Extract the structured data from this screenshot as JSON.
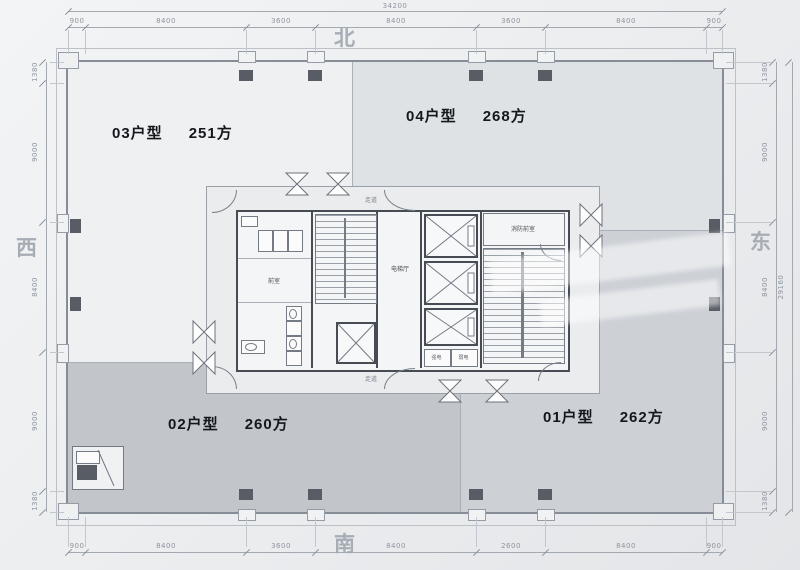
{
  "compass": {
    "north": "北",
    "south": "南",
    "west": "西",
    "east": "东"
  },
  "dims": {
    "total_top": "34200",
    "total_right": "29160",
    "top": [
      "900",
      "8400",
      "3600",
      "8400",
      "3600",
      "8400",
      "900"
    ],
    "bottom": [
      "900",
      "8400",
      "3600",
      "8400",
      "2600",
      "8400",
      "900"
    ],
    "left": [
      "1380",
      "9000",
      "8400",
      "9000",
      "1380"
    ],
    "right": [
      "1380",
      "9000",
      "8400",
      "9000",
      "1380"
    ]
  },
  "units": {
    "u03": {
      "name": "03户型",
      "area": "251方"
    },
    "u04": {
      "name": "04户型",
      "area": "268方"
    },
    "u02": {
      "name": "02户型",
      "area": "260方"
    },
    "u01": {
      "name": "01户型",
      "area": "262方"
    }
  },
  "core": {
    "elevator_hall": "电梯厅",
    "fire_lobby": "消防前室",
    "vestibule": "前室",
    "corridor_top": "走道",
    "corridor_bottom": "走道",
    "strong_power": "强电",
    "weak_power": "弱电"
  },
  "colors": {
    "unit03_fill": "#eef0f2",
    "unit04_fill": "#dfe2e5",
    "unit01_fill": "#cdd1d6",
    "unit02_fill": "#c2c6ca",
    "wall": "#868d96",
    "core_wall": "#474c54",
    "dim_text": "#8e949d"
  }
}
